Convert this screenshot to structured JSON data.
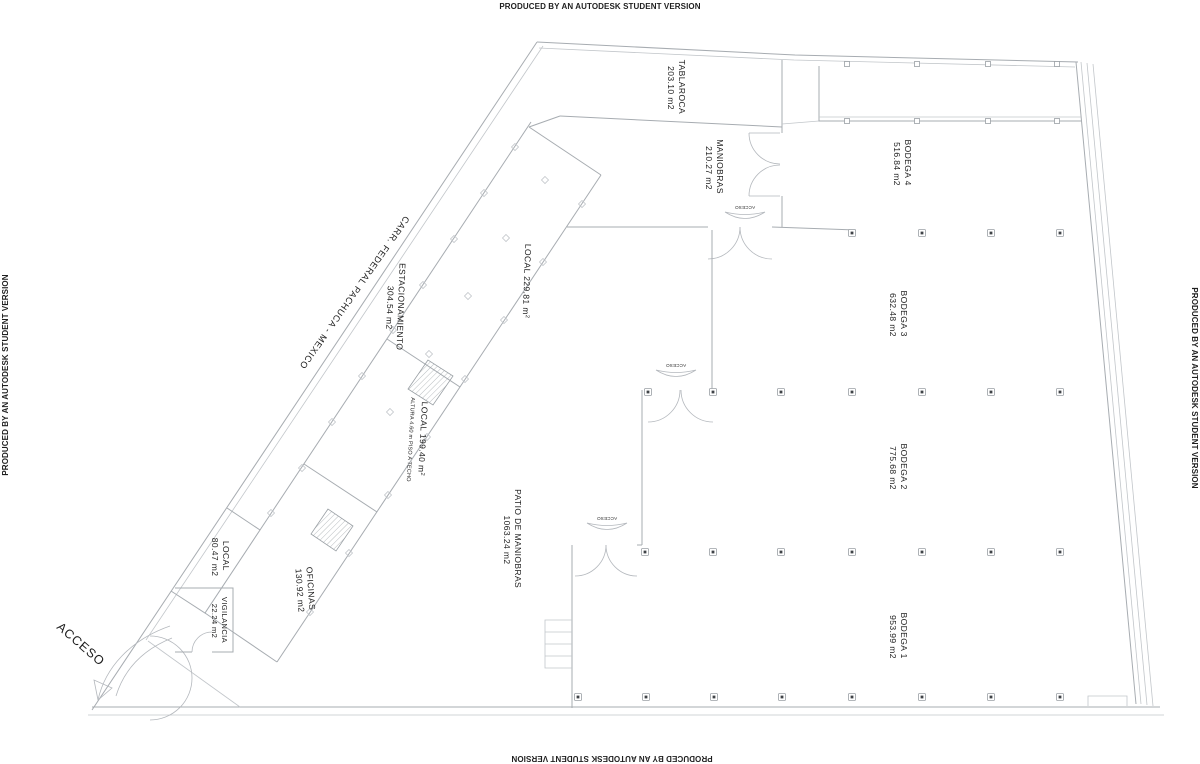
{
  "watermark": {
    "text": "PRODUCED BY AN AUTODESK STUDENT VERSION"
  },
  "site": {
    "road_label": "CARR. FEDERAL PACHUCA - MEXICO",
    "entrance_label": "ACCESO",
    "door_label_1": "ACCESO",
    "door_label_2": "ACCESO",
    "door_label_3": "ACCESO"
  },
  "rooms": {
    "tablaroca": {
      "name": "TABLAROCA",
      "area": "203.10 m2"
    },
    "maniobras": {
      "name": "MANIOBRAS",
      "area": "210.27 m2"
    },
    "bodega4": {
      "name": "BODEGA 4",
      "area": "516.84 m2"
    },
    "bodega3": {
      "name": "BODEGA 3",
      "area": "632.48 m2"
    },
    "bodega2": {
      "name": "BODEGA 2",
      "area": "775.68 m2"
    },
    "bodega1": {
      "name": "BODEGA 1",
      "area": "953.99 m2"
    },
    "patio": {
      "name": "PATIO DE MANIOBRAS",
      "area": "1063.24 m2"
    },
    "local229": {
      "name": "LOCAL 229.81 m",
      "sup": "2"
    },
    "local199": {
      "name": "LOCAL 199.40 m",
      "sup": "2",
      "note": "ALTURA 4.60 m PISO A TECHO"
    },
    "estacionamiento": {
      "name": "ESTACIONAMIENTO",
      "area": "304.54 m2"
    },
    "oficinas": {
      "name": "OFICINAS",
      "area": "130.92 m2"
    },
    "local80": {
      "name": "LOCAL",
      "area": "80.47 m2"
    },
    "vigilancia": {
      "name": "VIGILANCIA",
      "area": "22.24 m2"
    }
  }
}
